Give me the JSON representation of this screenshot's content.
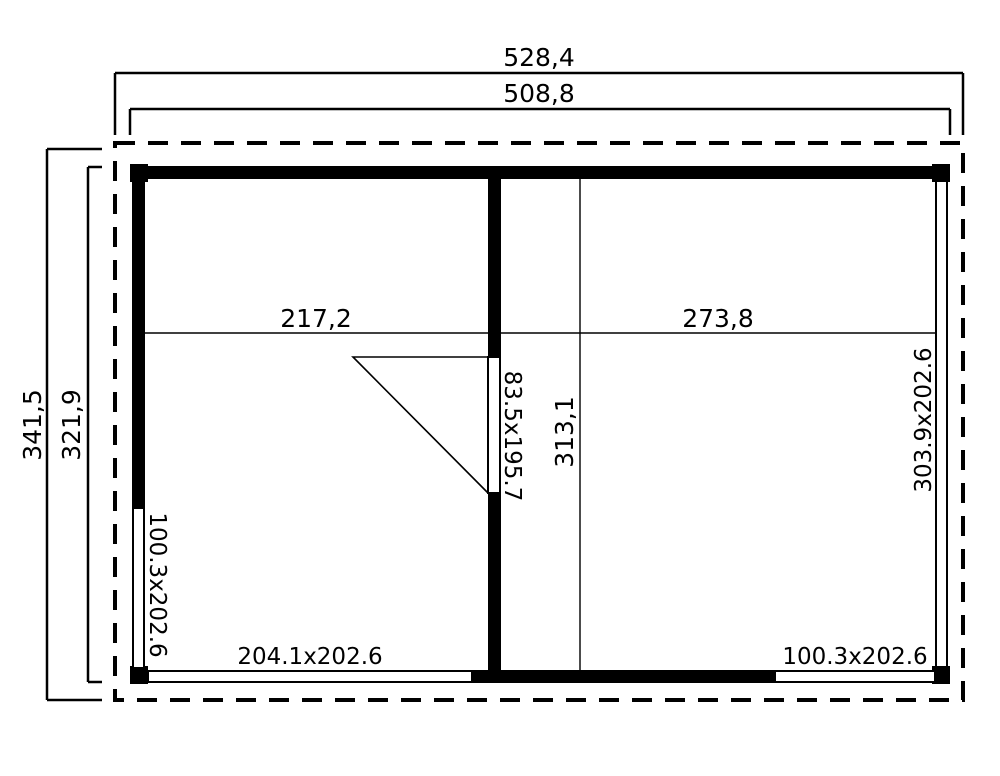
{
  "plan": {
    "dimensions": {
      "top_outer_width": "528,4",
      "top_wall_width": "508,8",
      "left_outer_height": "341,5",
      "left_wall_height": "321,9",
      "room_left_width": "217,2",
      "room_right_width": "273,8",
      "interior_depth": "313,1"
    },
    "openings": {
      "door": "83.5x195.7",
      "window_left_wall": "100.3x202.6",
      "window_bottom_left": "204.1x202.6",
      "window_bottom_right": "100.3x202.6",
      "window_right_wall": "303.9x202.6"
    },
    "colors": {
      "ink": "#000000",
      "paper": "#ffffff"
    }
  }
}
